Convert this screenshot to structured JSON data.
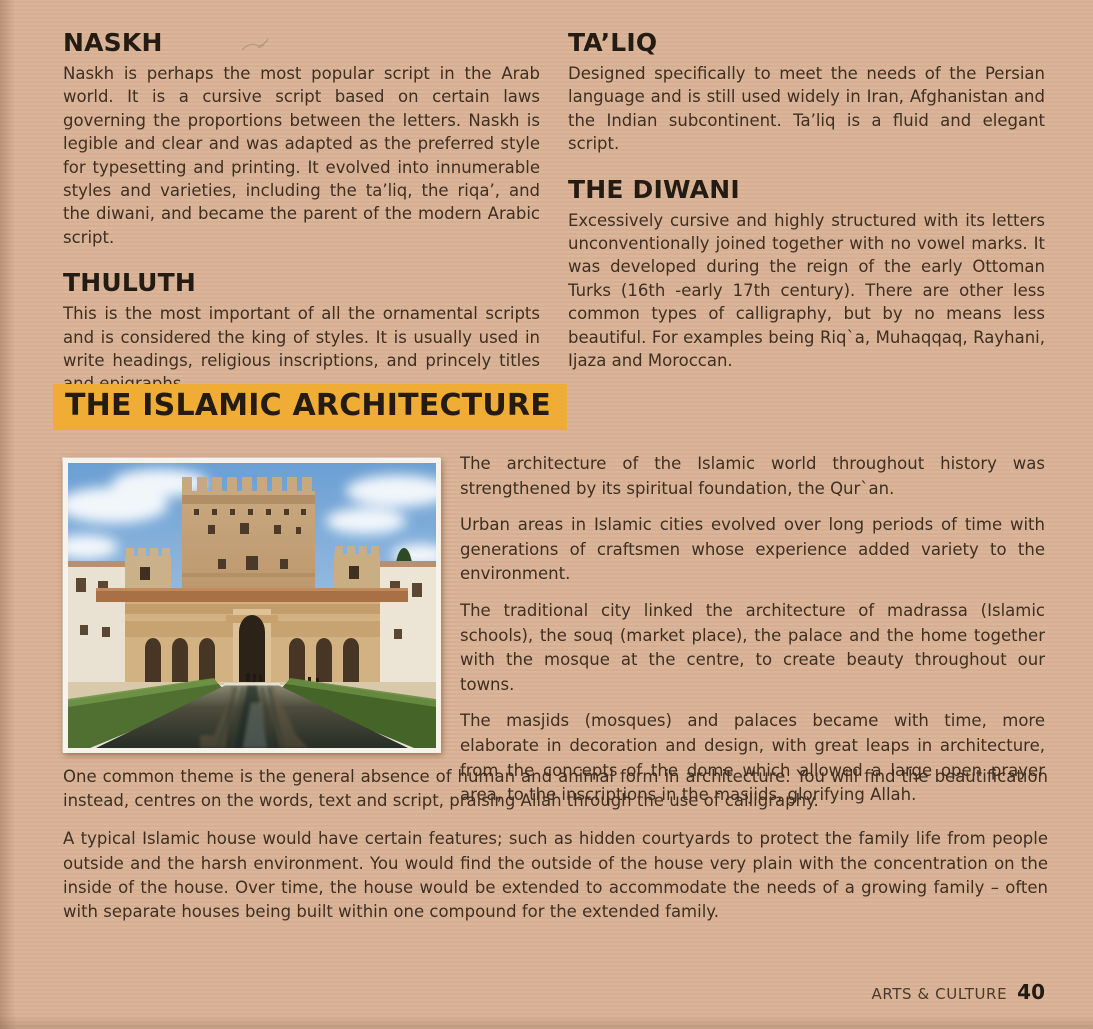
{
  "scripts_section": {
    "left_column": [
      {
        "heading": "NASKH",
        "body": "Naskh is perhaps the most popular script in the Arab world. It is a cursive script based on certain laws governing the proportions between the letters. Naskh is legible and clear and was adapted as the preferred style for typesetting and printing. It evolved into innumerable styles and varieties, including the ta’liq, the riqa’, and the diwani, and became the parent of the modern Arabic script."
      },
      {
        "heading": "THULUTH",
        "body": "This is the most important of all the ornamental scripts and is considered the king of styles. It is usually used in write headings, religious inscriptions, and princely titles and epigraphs."
      }
    ],
    "right_column": [
      {
        "heading": "TA’LIQ",
        "body": "Designed specifically to meet the needs of the Persian language and is still used widely in Iran, Afghanistan and the Indian subcontinent. Ta’liq is a fluid and elegant script."
      },
      {
        "heading": "THE DIWANI",
        "body": "Excessively cursive and highly structured with its letters unconventionally joined together with no vowel marks. It was developed during the reign of the early Ottoman Turks (16th -early 17th century). There are other less common types of calligraphy, but by no means less beautiful. For examples being Riq`a, Muhaqqaq, Rayhani, Ijaza and Moroccan."
      }
    ]
  },
  "architecture_section": {
    "heading": "THE ISLAMIC ARCHITECTURE",
    "highlight_color": "#f0ad35",
    "photo": {
      "subject": "islamic-palace-courtyard-with-reflecting-pool"
    },
    "paragraphs_beside_photo": [
      "The architecture of the Islamic world throughout history was strengthened by its spiritual foundation, the Qur`an.",
      "Urban areas in Islamic cities evolved over long periods of time with generations of craftsmen whose experience added variety to the environment.",
      "The traditional city linked the architecture of madrassa (Islamic schools), the souq (market place), the palace and the home together with the mosque at the centre, to create beauty throughout our towns.",
      "The masjids (mosques) and palaces became with time, more elaborate in decoration and design, with great leaps in architecture, from the concepts of the dome which allowed a large open prayer area, to the inscriptions in the masjids, glorifying Allah."
    ],
    "paragraphs_full_width": [
      "One common theme is the general absence of human and animal form in architecture. You will find the beautification instead, centres on the words, text and script, praising Allah through the use of calligraphy.",
      "A typical Islamic house would have certain features; such as hidden courtyards to protect the family life from people outside and the harsh environment. You would find the outside of the house very plain with the concentration on the inside of the house. Over time, the house would be extended to accommodate the needs of a growing family – often with separate houses being built within one compound for the extended family."
    ]
  },
  "footer": {
    "label": "ARTS & CULTURE",
    "page_number": "40"
  },
  "colors": {
    "page_background": "#d9b295",
    "heading_text": "#241b13",
    "body_text": "#3e2f22",
    "highlight": "#f0ad35"
  }
}
